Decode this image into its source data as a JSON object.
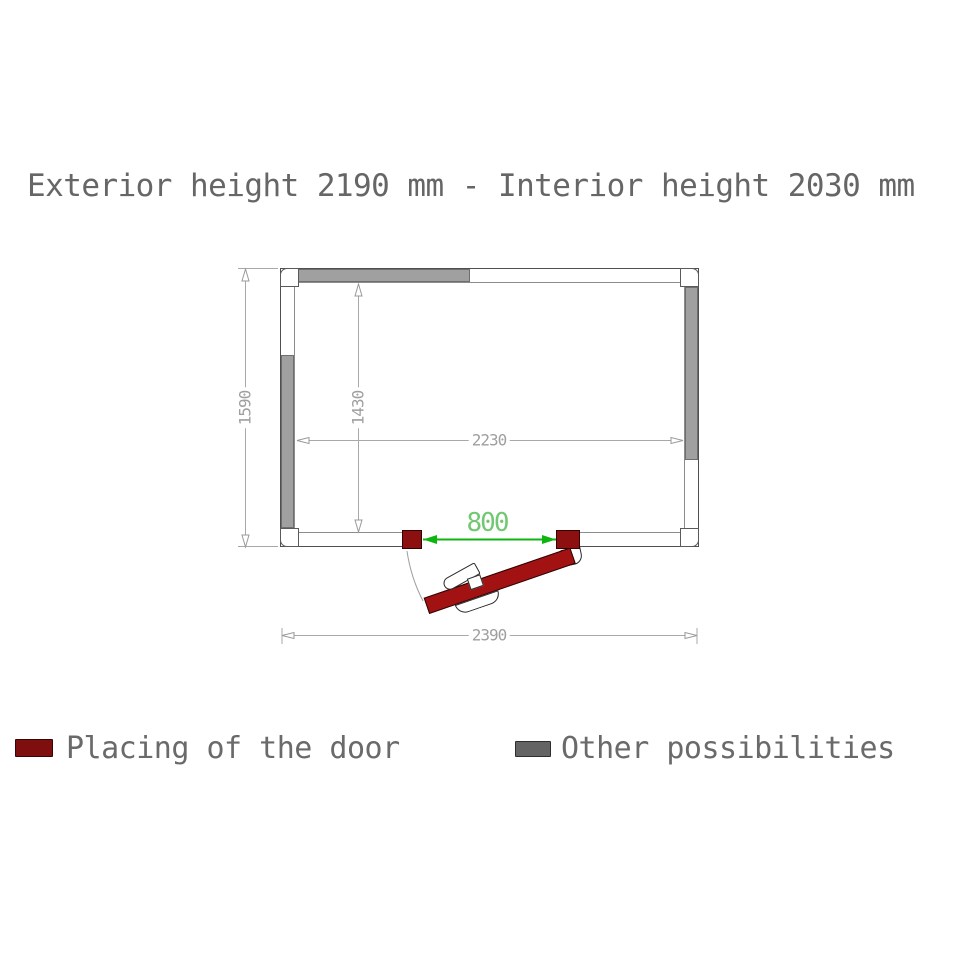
{
  "title": "Exterior height 2190 mm - Interior height 2030 mm",
  "plan": {
    "exterior_width_mm": "2390",
    "exterior_depth_mm": "1590",
    "interior_width_mm": "2230",
    "interior_depth_mm": "1430",
    "door_opening_mm": "800"
  },
  "legend": {
    "door": {
      "label": "Placing of the door",
      "color": "#7f0f0f"
    },
    "other": {
      "label": "Other possibilities",
      "color": "#646464"
    }
  },
  "colors": {
    "door_leaf": "#a31212",
    "door_post": "#8c1010",
    "other_possibility_wall": "#a0a0a0",
    "dimension_lines": "#a8a8a8",
    "door_dimension_line": "#10b410",
    "door_dimension_text": "#72c872",
    "title_text": "#666666"
  }
}
